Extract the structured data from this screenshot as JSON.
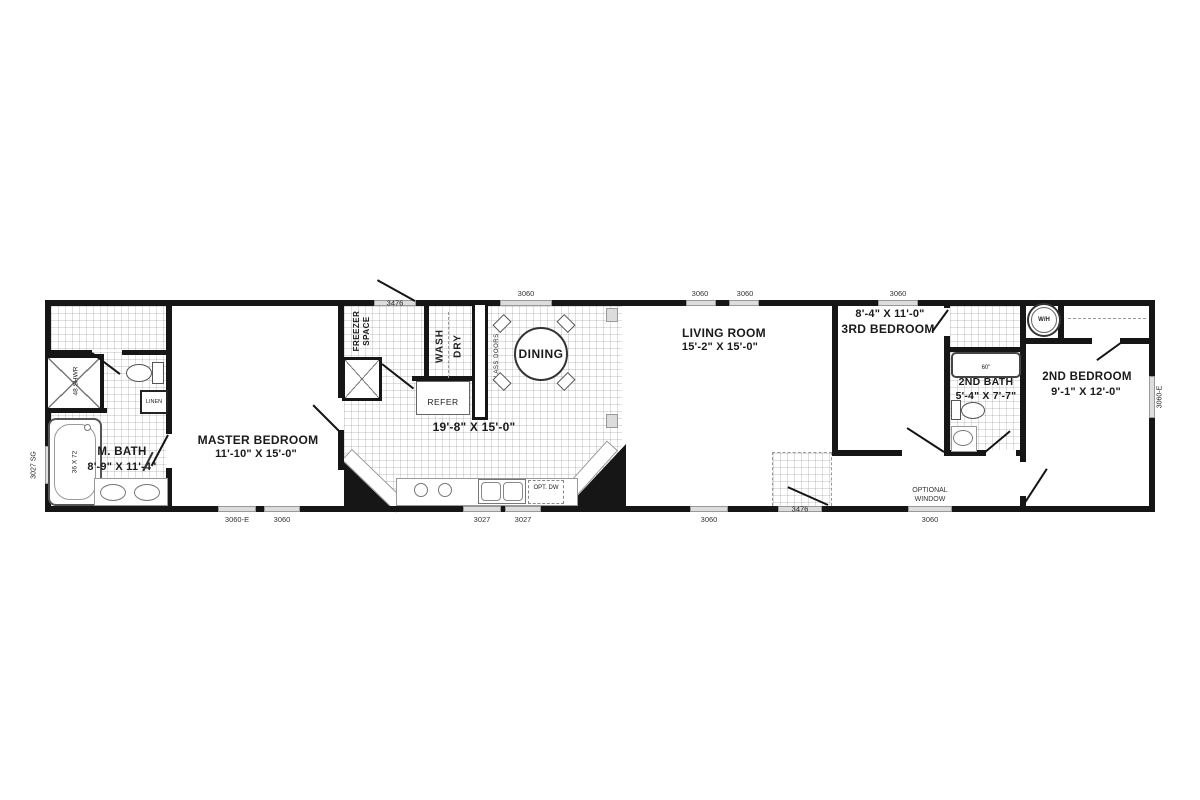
{
  "plan": {
    "rooms": {
      "master_bath": {
        "name": "M. BATH",
        "dims": "8'-9\" X 11'-4\""
      },
      "master_bedroom": {
        "name": "MASTER BEDROOM",
        "dims": "11'-10\" X 15'-0\""
      },
      "kitchen": {
        "dims": "19'-8\" X 15'-0\""
      },
      "dining": {
        "name": "DINING"
      },
      "living_room": {
        "name": "LIVING ROOM",
        "dims": "15'-2\" X 15'-0\""
      },
      "third_bedroom": {
        "name": "3RD BEDROOM",
        "dims": "8'-4\" X 11'-0\""
      },
      "second_bath": {
        "name": "2ND BATH",
        "dims": "5'-4\" X 7'-7\""
      },
      "second_bedroom": {
        "name": "2ND BEDROOM",
        "dims": "9'-1\" X 12'-0\""
      }
    },
    "fixtures": {
      "freezer_space": "FREEZER SPACE",
      "wash": "WASH",
      "dry": "DRY",
      "refer": "REFER",
      "glass_doors": "GLASS DOORS",
      "linen": "LINEN",
      "shower": "48 SHWR",
      "master_tub": "36 X 72",
      "second_tub": "60\"",
      "water_heater": "W/H",
      "opt_dw": "OPT. DW",
      "optional_window": "OPTIONAL WINDOW"
    },
    "openings": {
      "top": [
        "3476",
        "3060",
        "3060",
        "3060",
        "3060"
      ],
      "bottom": [
        "3060-E",
        "3060",
        "3027",
        "3027",
        "3060",
        "3476",
        "3060"
      ],
      "left": [
        "3027 SG"
      ],
      "right": [
        "3060-E"
      ]
    },
    "colors": {
      "wall": "#161616",
      "window_fill": "#dcdcdc",
      "floor": "#ffffff"
    }
  }
}
